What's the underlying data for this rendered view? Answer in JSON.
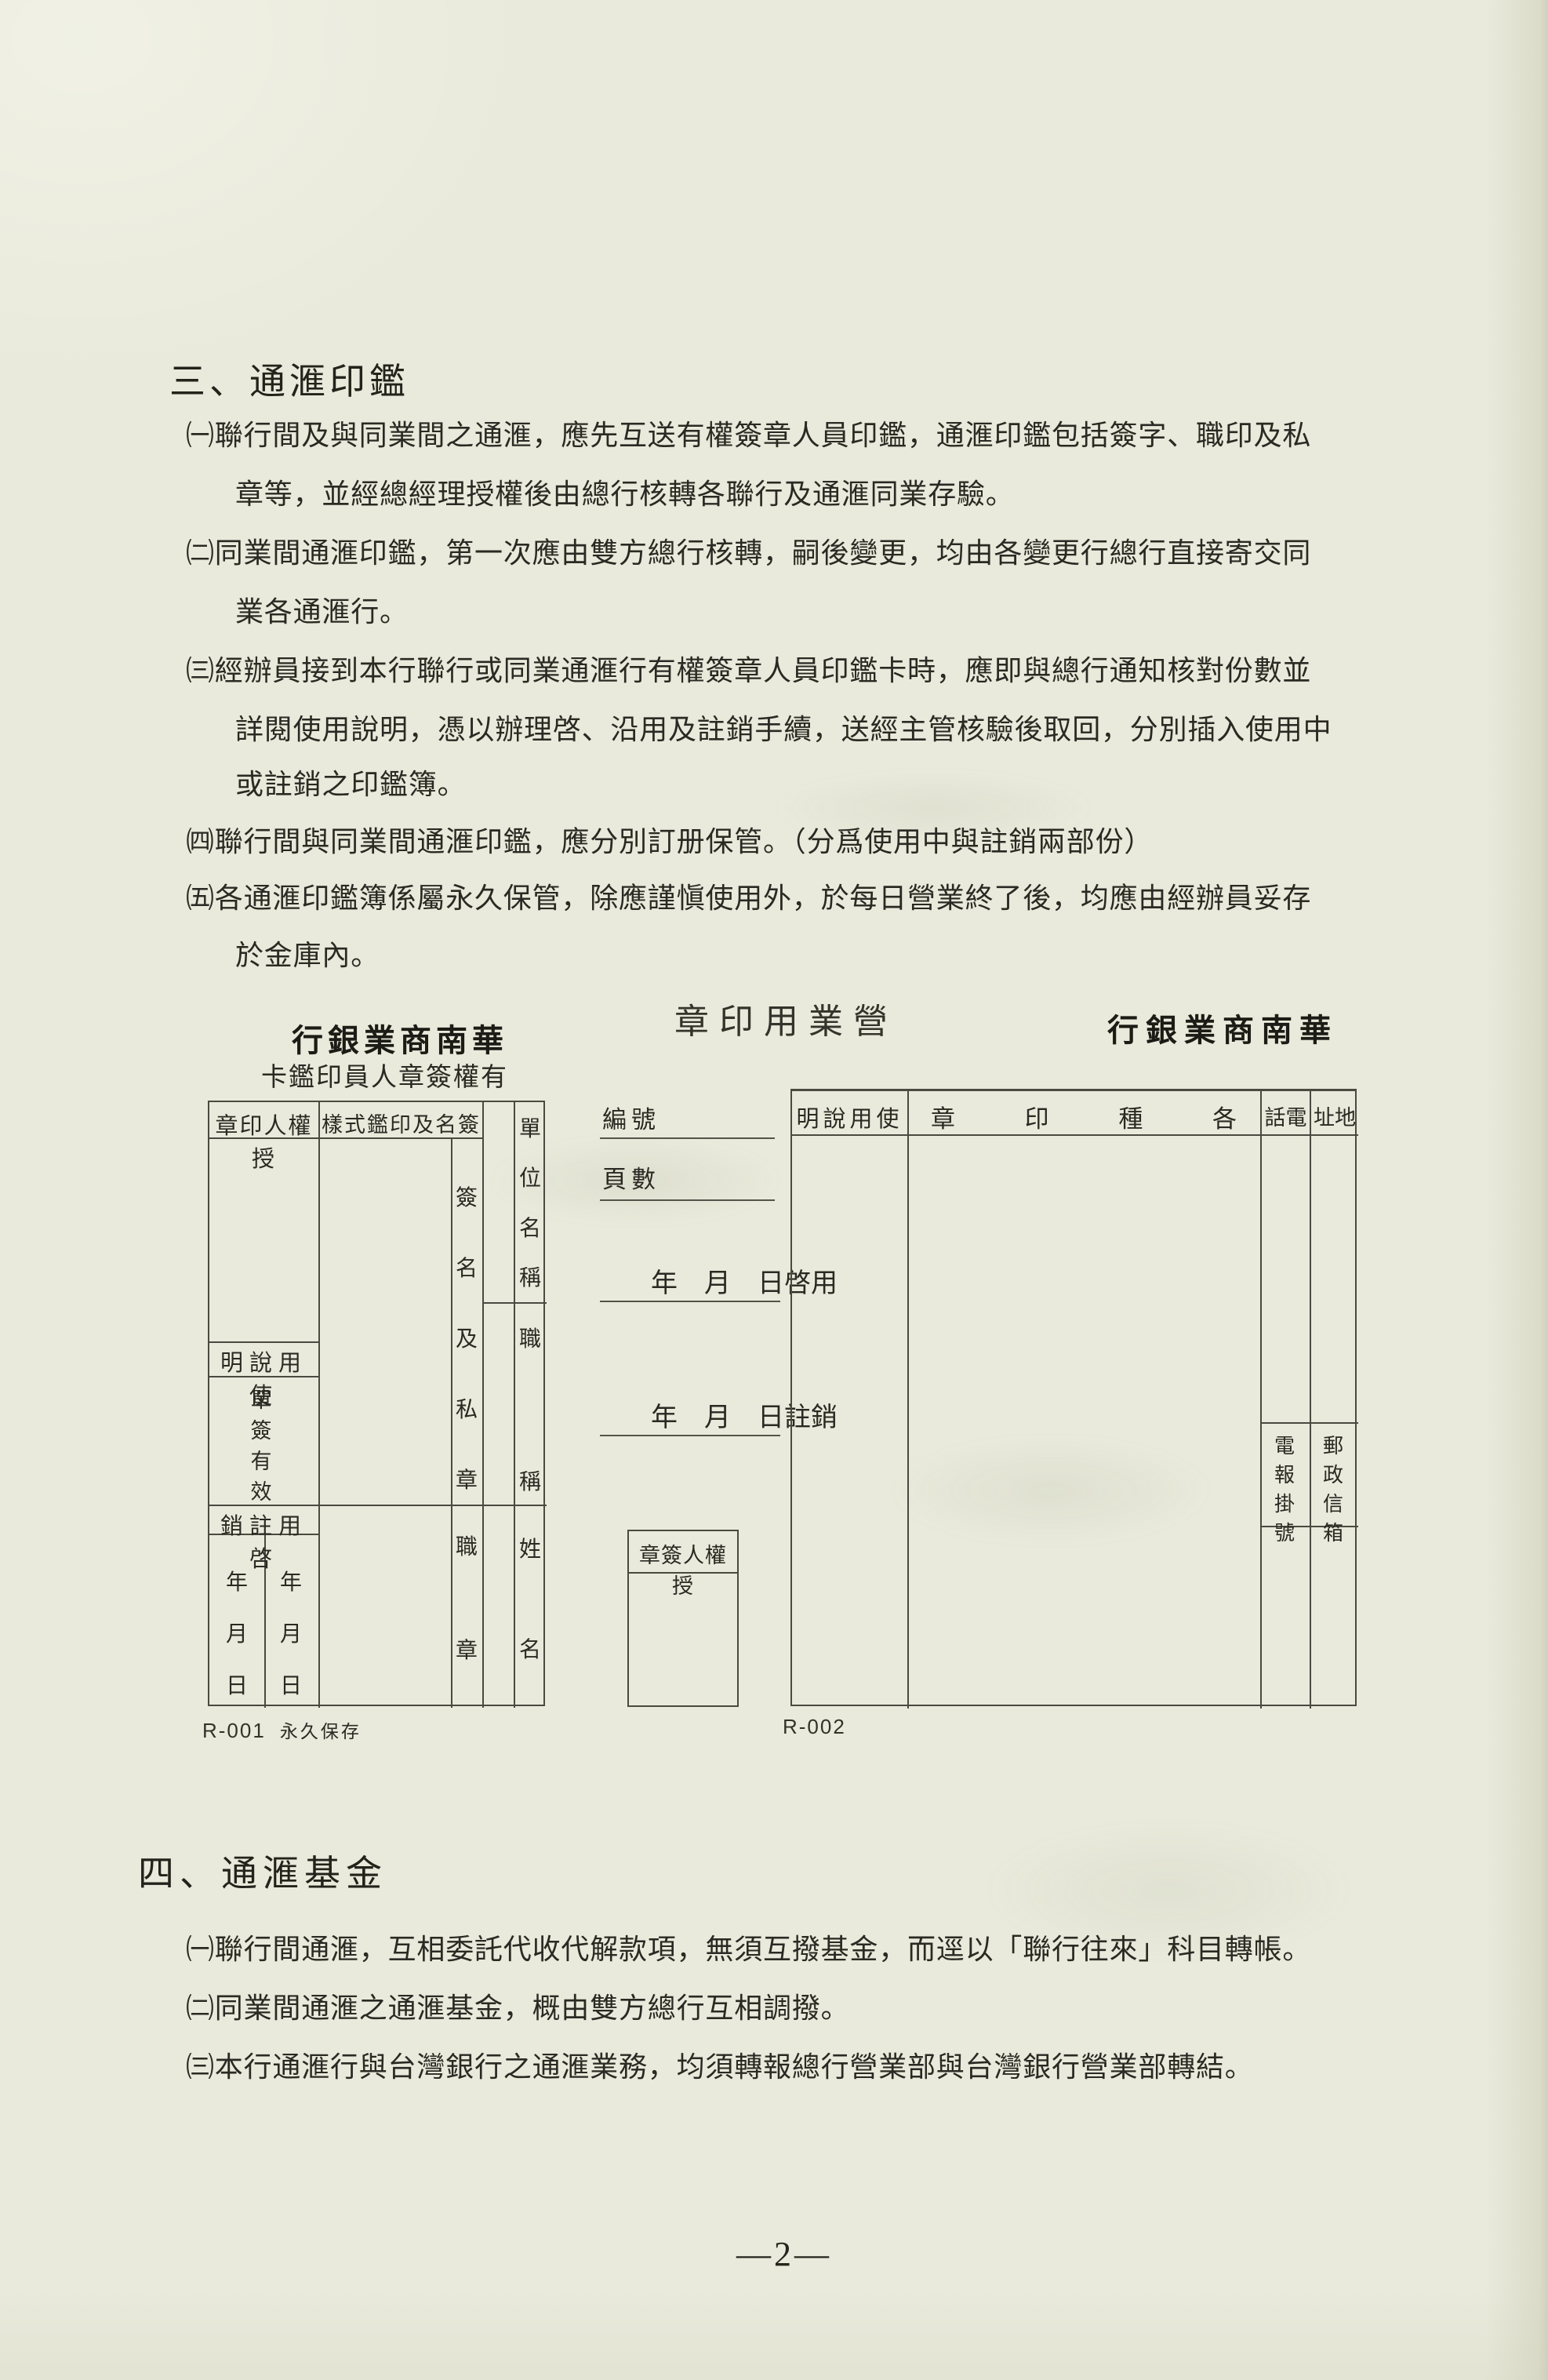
{
  "page": {
    "number": "—2—"
  },
  "colors": {
    "paper": "#e9eadb",
    "ink": "#2b2923",
    "rule": "#4b4940"
  },
  "section3": {
    "heading": "三、通滙印鑑",
    "lines": [
      "㈠聯行間及與同業間之通滙，應先互送有權簽章人員印鑑，通滙印鑑包括簽字、職印及私",
      "章等，並經總經理授權後由總行核轉各聯行及通滙同業存驗。",
      "㈡同業間通滙印鑑，第一次應由雙方總行核轉，嗣後變更，均由各變更行總行直接寄交同",
      "業各通滙行。",
      "㈢經辦員接到本行聯行或同業通滙行有權簽章人員印鑑卡時，應即與總行通知核對份數並",
      "詳閱使用說明，憑以辦理啓、沿用及註銷手續，送經主管核驗後取回，分別插入使用中",
      "或註銷之印鑑簿。",
      "㈣聯行間與同業間通滙印鑑，應分別訂册保管。（分爲使用中與註銷兩部份）",
      "㈤各通滙印鑑簿係屬永久保管，除應謹愼使用外，於每日營業終了後，均應由經辦員妥存",
      "於金庫內。"
    ]
  },
  "center_title": "章印用業營",
  "left_form": {
    "bank_name": "行銀業商南華",
    "card_title": "卡鑑印員人章簽權有",
    "col1_header": "章印人權授",
    "col2_header": "樣式鑑印及名簽",
    "usage_header": "明說用使",
    "single_sign_valid": "單簽有效",
    "activate_cancel_header": "銷註用啓",
    "date_col_left": "年月日",
    "date_col_right": "年月日",
    "sig_private_seal": "簽名及私章",
    "duty_seal": "職章",
    "unit_name": "單位名稱",
    "job_title": "職稱",
    "person_name": "姓名",
    "form_no": "R-001",
    "retention": "永久保存"
  },
  "middle_form": {
    "serial_label": "編號",
    "pages_label": "頁數",
    "activate_line": "年　月　日啓用",
    "cancel_line": "年　月　日註銷",
    "authorizer_box_header": "章簽人權授",
    "form_no": "R-002"
  },
  "right_form": {
    "bank_name": "行銀業商南華",
    "usage_header": "明說用使",
    "seals_header": "章印種各",
    "phone_header": "話電",
    "address_header": "址地",
    "telegraph_label": "電報掛號",
    "pobox_label": "郵政信箱"
  },
  "section4": {
    "heading": "四、通滙基金",
    "lines": [
      "㈠聯行間通滙，互相委託代收代解款項，無須互撥基金，而逕以「聯行往來」科目轉帳。",
      "㈡同業間通滙之通滙基金，概由雙方總行互相調撥。",
      "㈢本行通滙行與台灣銀行之通滙業務，均須轉報總行營業部與台灣銀行營業部轉結。"
    ]
  }
}
